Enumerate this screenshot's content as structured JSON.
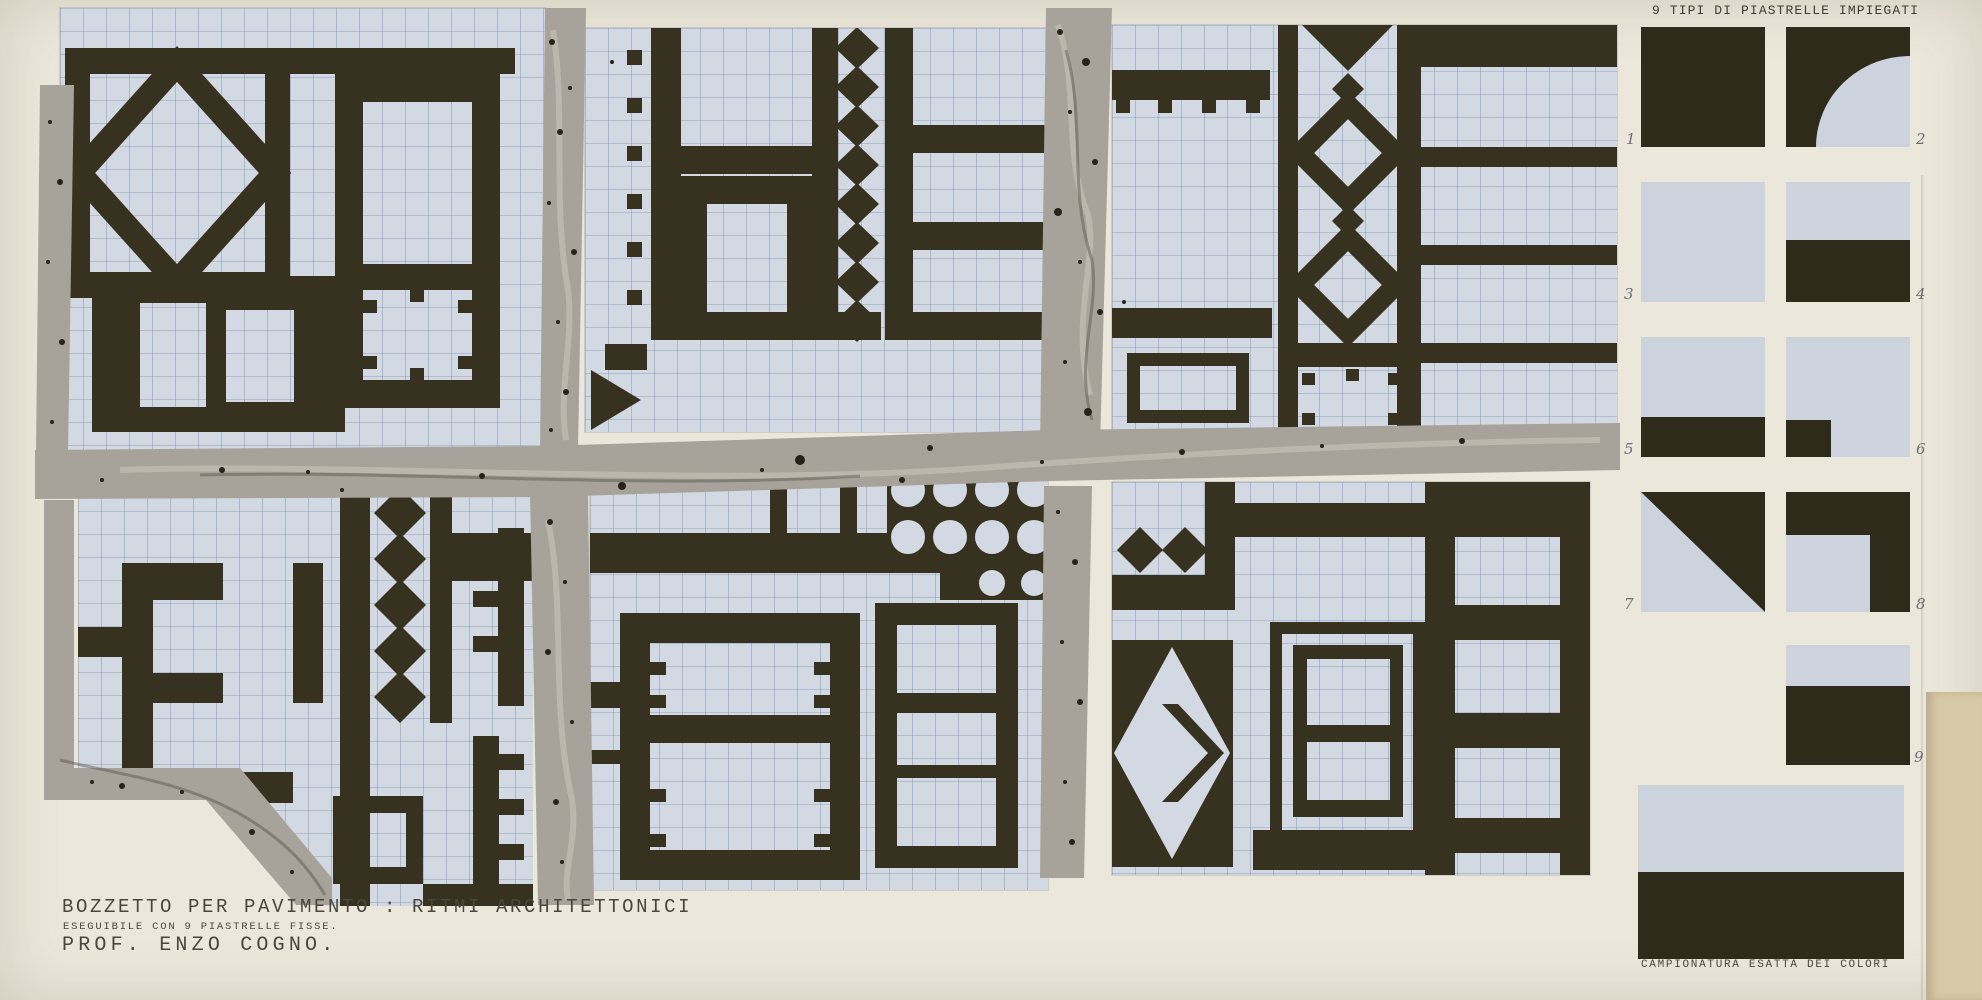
{
  "artwork": {
    "kind": "hand-painted floor pavement design on graph paper",
    "panel_count": 6,
    "panel_motifs": [
      "square-frame-with-inscribed-diamond-and-notched-window-frames",
      "bars-grid-with-solid-diamond-column-and-small-square-dots",
      "comb-bars-outlined-diamond-column-and-horizontal-stripes",
      "rectangular-spiral-solid-diamond-column-and-comb-teeth",
      "circle-perforated-block-and-divided-window-frames",
      "paired-diamonds-double-frame-windows-and-stripes"
    ]
  },
  "sidebar": {
    "heading": "9 TIPI DI PIASTRELLE IMPIEGATI",
    "tile_labels": [
      "1",
      "2",
      "3",
      "4",
      "5",
      "6",
      "7",
      "8",
      "9"
    ],
    "tile_types": [
      "solid-dark",
      "dark-with-light-quarter-circle-bottom-right",
      "solid-light",
      "light-top-dark-bottom-half",
      "light-with-dark-bottom-strip",
      "light-with-dark-square-bottom-left",
      "diagonal-dark-upper-right-triangle",
      "dark-corner-L-with-light-square-bottom-left",
      "light-top-third-dark-bottom"
    ],
    "swatch_caption": "CAMPIONATURA ESATTA DEI COLORI",
    "swatch_colors": [
      {
        "name": "light-blue-gray",
        "hex": "#CCD3DC"
      },
      {
        "name": "dark-olive-black",
        "hex": "#2E2B1B"
      }
    ]
  },
  "title_block": {
    "line1": "BOZZETTO PER PAVIMENTO : RITMI ARCHITETTONICI",
    "line2": "ESEGUIBILE CON 9 PIASTRELLE FISSE.",
    "line3": "PROF. ENZO COGNO."
  },
  "colors": {
    "paper_cream": "#EBE7DA",
    "graph_paper_light": "#D3D9E2",
    "pattern_dark_olive": "#37321F",
    "grout_gray": "#A7A39A",
    "tan_paper_edge": "#D8C9A9"
  }
}
